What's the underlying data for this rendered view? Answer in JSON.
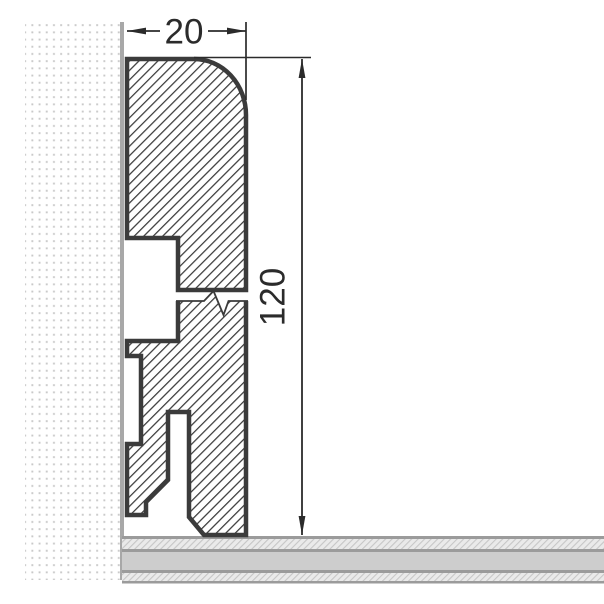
{
  "drawing": {
    "type": "technical-cross-section",
    "subject": "skirting-board-profile-on-wall-and-floor",
    "dimensions": {
      "width": {
        "label": "20"
      },
      "height": {
        "label": "120"
      }
    },
    "colors": {
      "background": "#ffffff",
      "profile_outline": "#3b3b3b",
      "hatch_line": "#3b3b3b",
      "dimension_ink": "#2b2b2b",
      "wall_dots": "#c9c9c9",
      "wall_edge": "#a8a8a8",
      "floor_solid_band": "#cdcdcd",
      "floor_hatch_bg": "#eaeaea",
      "floor_hatch_line": "#c6c6c6",
      "floor_divider": "#9b9b9b"
    }
  }
}
